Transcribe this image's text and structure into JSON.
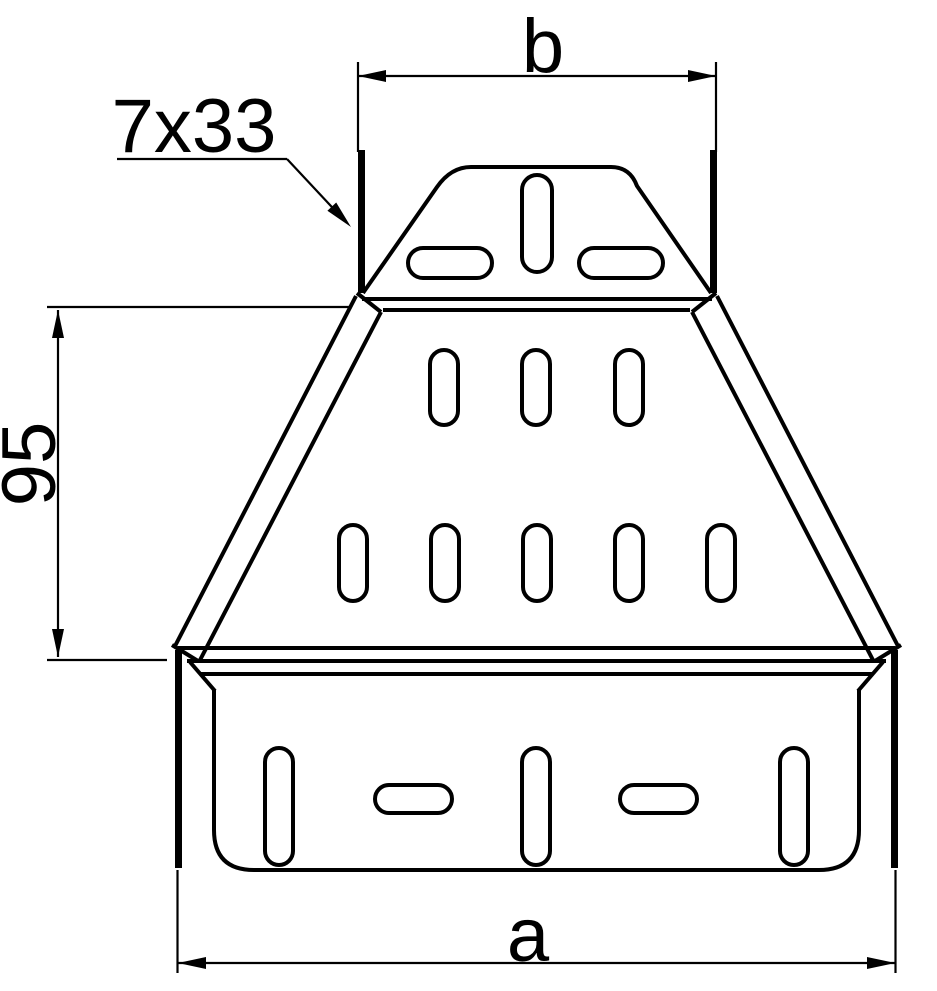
{
  "drawing": {
    "type": "technical-drawing",
    "subject": "symmetrical cable tray reducer, top view",
    "background_color": "#ffffff",
    "line_color": "#000000",
    "dimensions": {
      "top_width_label": "b",
      "bottom_width_label": "a",
      "reducer_height_label": "95",
      "slot_callout_label": "7x33"
    },
    "features": {
      "top_flange_slots": {
        "vertical": 1,
        "horizontal": 2
      },
      "taper_upper_row_slots": 3,
      "taper_lower_row_slots": 5,
      "bottom_panel_slots": {
        "vertical": 3,
        "horizontal": 2
      }
    }
  }
}
